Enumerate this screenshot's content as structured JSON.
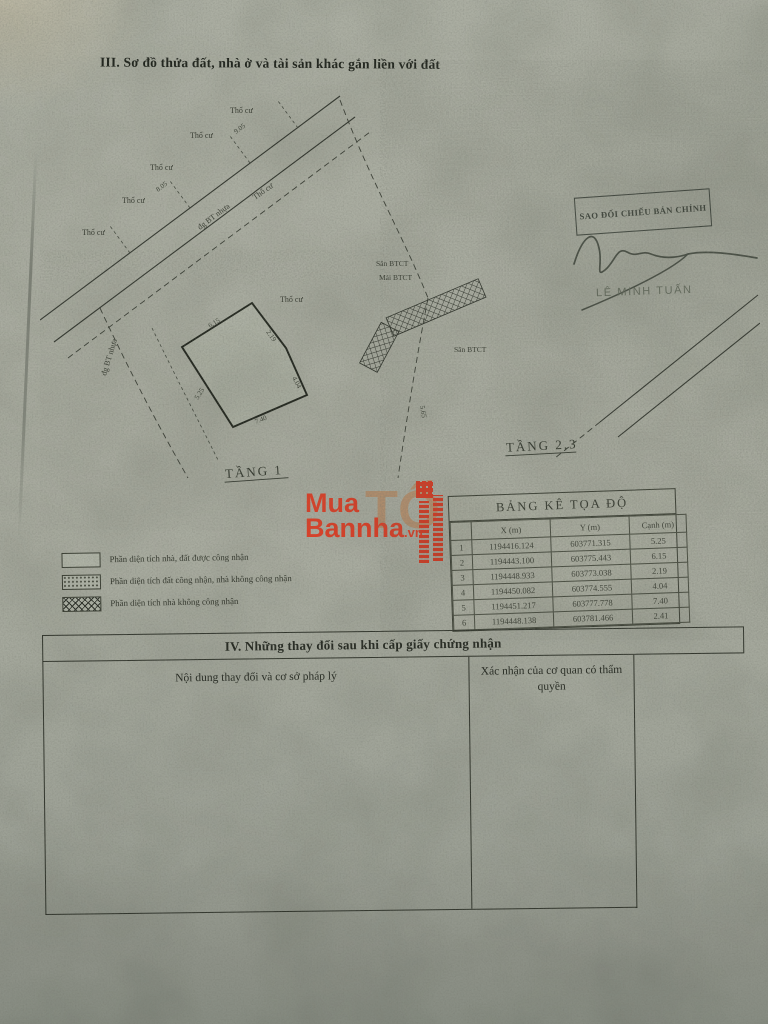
{
  "page": {
    "section3_title": "III. Sơ đồ thửa đất, nhà ở và tài sản khác gắn liền với đất"
  },
  "diagram": {
    "floor1_label": "TẦNG 1",
    "floor23_label": "TẦNG 2,3",
    "land_label": "Thổ cư",
    "road_label": "đg BT nhựa",
    "structure_label_1": "Sân BTCT",
    "structure_label_2": "Mái BTCT",
    "dim_1": "8.05",
    "dim_2": "9.05",
    "dim_3": "5.65",
    "edge_1": "2.19",
    "edge_2": "6.15",
    "edge_3": "7.40",
    "edge_4": "5.25",
    "edge_5": "4.04"
  },
  "stamp": {
    "label": "SAO ĐỐI CHIẾU BẢN CHÍNH",
    "signer": "LÊ MINH TUẤN"
  },
  "watermark": {
    "line1": "Mua",
    "line2": "Bannha",
    "suffix": ".vn",
    "ghost": "TỐ",
    "color": "#dd3f27"
  },
  "coord_table": {
    "title": "BẢNG KÊ TỌA ĐỘ",
    "col_x": "X (m)",
    "col_y": "Y (m)",
    "col_edge": "Cạnh (m)",
    "rows": [
      {
        "no": "1",
        "x": "1194416.124",
        "y": "603771.315",
        "edge": "5.25"
      },
      {
        "no": "2",
        "x": "1194443.100",
        "y": "603775.443",
        "edge": "6.15"
      },
      {
        "no": "3",
        "x": "1194448.933",
        "y": "603773.038",
        "edge": "2.19"
      },
      {
        "no": "4",
        "x": "1194450.082",
        "y": "603774.555",
        "edge": "4.04"
      },
      {
        "no": "5",
        "x": "1194451.217",
        "y": "603777.778",
        "edge": "7.40"
      },
      {
        "no": "6",
        "x": "1194448.138",
        "y": "603781.466",
        "edge": "2.41"
      }
    ]
  },
  "legend": {
    "items": [
      {
        "label": "Phần diện tích nhà, đất được công nhận"
      },
      {
        "label": "Phần diện tích đất công nhận, nhà không công nhận"
      },
      {
        "label": "Phần diện tích nhà không công nhận"
      }
    ]
  },
  "section4": {
    "title": "IV. Những thay đổi sau khi cấp giấy chứng nhận",
    "col1_header": "Nội dung thay đổi và cơ sở pháp lý",
    "col2_header": "Xác nhận của cơ quan có thẩm quyền"
  }
}
